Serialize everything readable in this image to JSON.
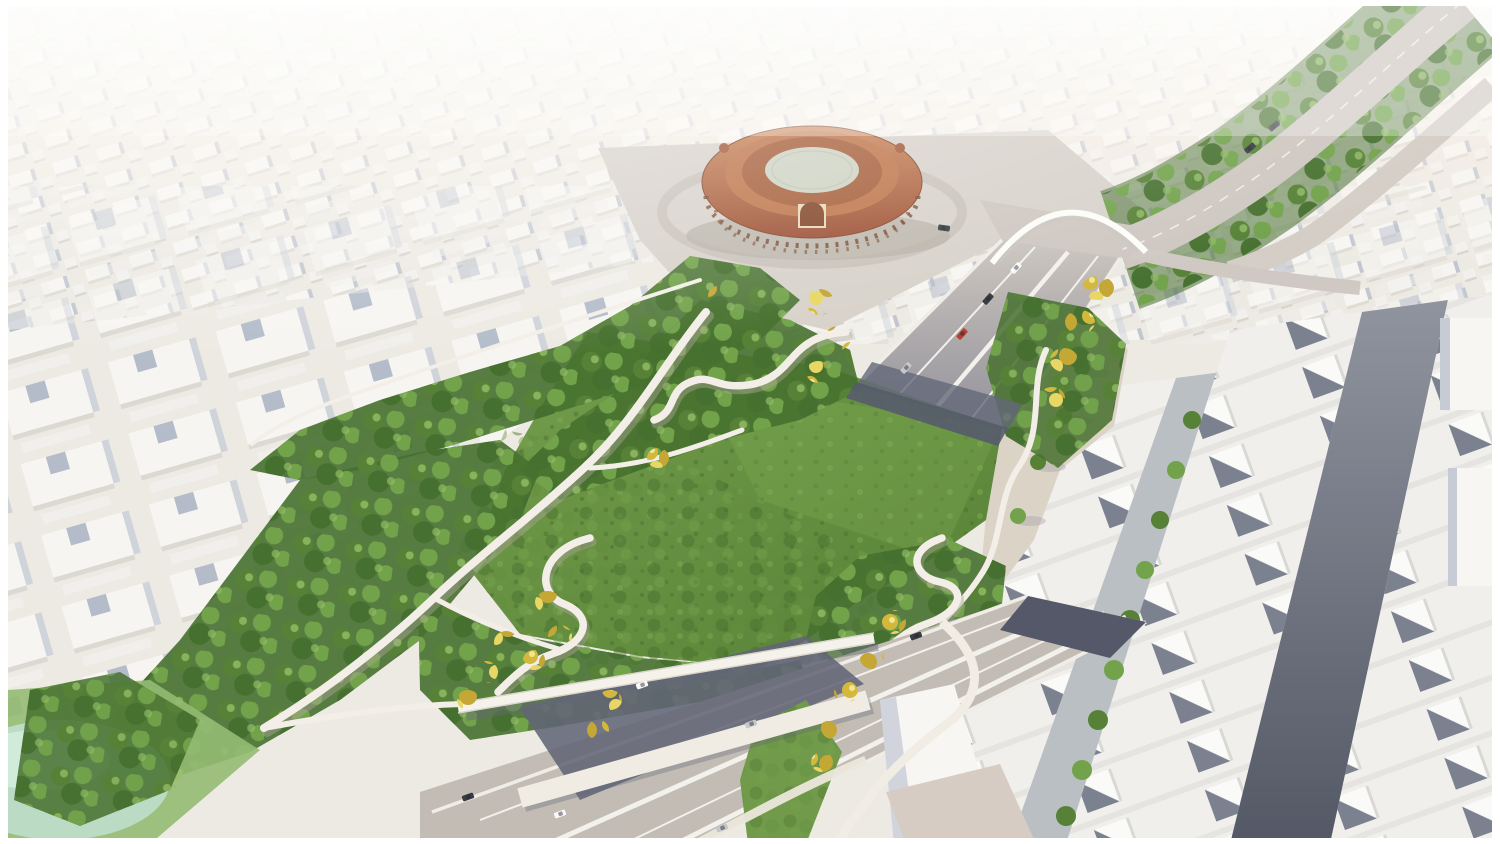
{
  "scene": {
    "description": "Aerial 3D architectural rendering of a proposed linear cap park built over a sunken urban motorway, beside a historic round brick bullring arena; the surrounding city is shown as an untextured white massing model.",
    "landmarks": {
      "bullring": "Historic brick bullring arena with oval arcaded facade",
      "plaza": "Paved plaza and roads surrounding the arena",
      "avenue": "Tree-lined avenue curving toward the upper-right",
      "arch_bridge": "White arch footbridge spanning the tunnel approach",
      "north_trench": "Motorway descending into a tunnel beneath the park",
      "park": "Cap park with dense tree canopy and winding white walkways",
      "meadow": "Large open green meadow at the center of the park",
      "serpentine_ramps": "S-shaped white accessibility ramps threading the trees",
      "south_trench": "Open multi-lane motorway trench with traffic",
      "footbridges": "Pedestrian bridges over the trench lined with yellow poplars",
      "residential_rows": "Parallel rows of white residential slabs with shaded courtyards",
      "city_massing": "Abstract white block model of the surrounding city",
      "pond": "Pale teal pond at the lower-left park corner"
    },
    "traffic": "A handful of white, silver, black and one red car travel the motorway lanes"
  },
  "colors": {
    "city_base": "#eeeae4",
    "building_white": "#f8f7f5",
    "building_shadow": "#aeb7c9",
    "canopy_dark": "#3e6a26",
    "canopy_mid": "#4e7c2e",
    "canopy_light": "#6ca044",
    "canopy_highlight": "#8cb95e",
    "autumn_yellow": "#d3b634",
    "autumn_light": "#e8d65e",
    "meadow_light": "#6f9c46",
    "meadow_dark": "#4e7a2c",
    "road_light": "#cdc6c0",
    "trench_pavement": "#c0bab4",
    "trench_shadow": "#5b5f72",
    "street_dark": "#565b6c",
    "brick_light": "#c77c4b",
    "brick_dark": "#96462a",
    "path_white": "#f4f0e9",
    "plaza_tan": "#d7d1ca",
    "esplanade_tan": "#dbd3c6",
    "pond_teal": "#bfe0d0",
    "car_red": "#b23a2c"
  }
}
